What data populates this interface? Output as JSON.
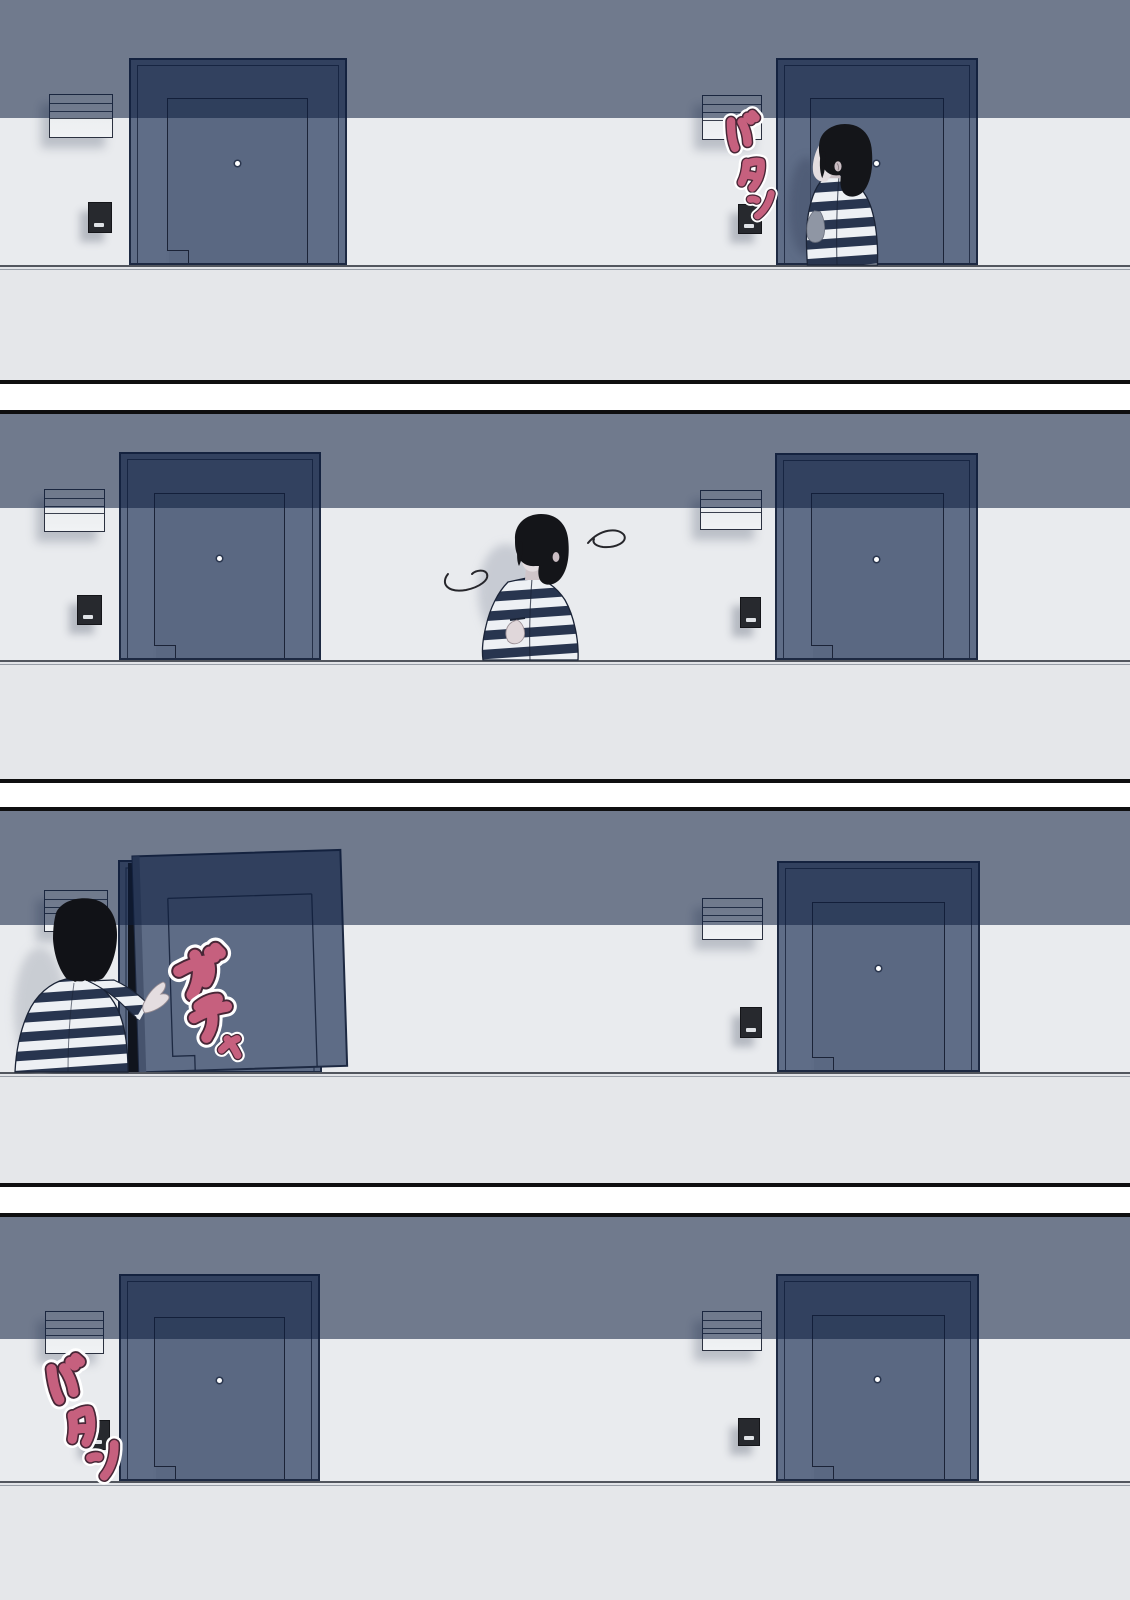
{
  "page": {
    "type": "four-panel-comic",
    "panel_count": 4
  },
  "panels": [
    {
      "id": 1,
      "scene": "woman-at-right-door",
      "sfx": "バタン"
    },
    {
      "id": 2,
      "scene": "woman-looking-around-corridor",
      "sfx": ""
    },
    {
      "id": 3,
      "scene": "woman-opening-left-door",
      "sfx": "ガチャ"
    },
    {
      "id": 4,
      "scene": "empty-corridor-door-closed",
      "sfx": "バタン"
    }
  ],
  "colors": {
    "sfx_pink": "#c6607e",
    "sfx_halo": "#ffffff",
    "wall_upper_band": "#697b92",
    "wall_lower": "#e9ebee",
    "floor": "#e5e7ea",
    "door": "#5f6d87",
    "door_in_shadow": "#2f3d58",
    "outline_navy": "#1d2942",
    "hair_black": "#141519",
    "skin": "#e4dde0",
    "stripe_navy": "#28354f",
    "stripe_white": "#edf0f4"
  }
}
